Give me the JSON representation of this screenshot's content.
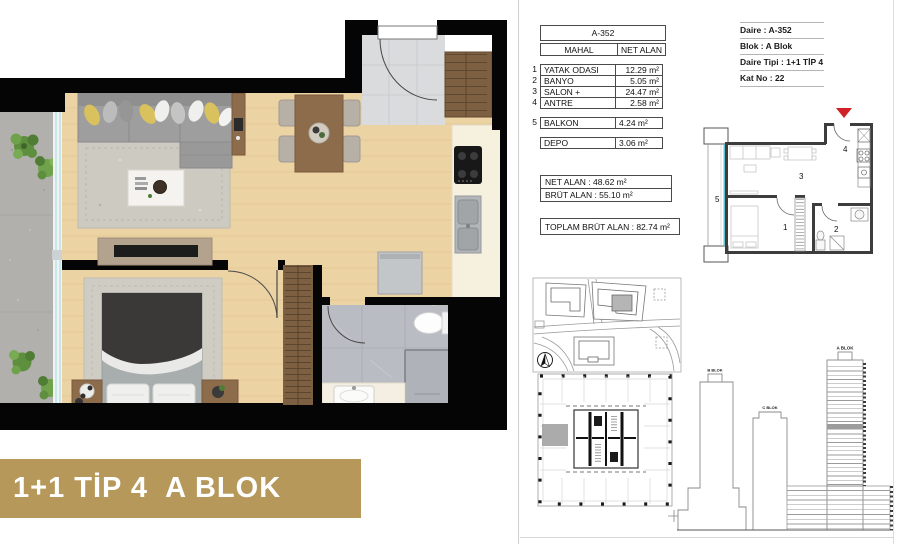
{
  "footer": {
    "label": "1+1 TİP 4  A BLOK"
  },
  "unit_table": {
    "unit_no": "A-352",
    "columns": {
      "mahal": "MAHAL",
      "net_alan": "NET ALAN"
    },
    "rows": [
      {
        "no": "1",
        "name": "YATAK ODASI",
        "area": "12.29 m²"
      },
      {
        "no": "2",
        "name": "BANYO",
        "area": "5.05 m²"
      },
      {
        "no": "3",
        "name": "SALON + MUTFAK",
        "area": "24.47 m²"
      },
      {
        "no": "4",
        "name": "ANTRE",
        "area": "2.58 m²"
      }
    ],
    "balkon_row": {
      "no": "5",
      "name": "BALKON",
      "area": "4.24 m²"
    },
    "depo_row": {
      "no": "",
      "name": "DEPO",
      "area": "3.06 m²"
    },
    "summary": {
      "net": "NET ALAN : 48.62 m²",
      "brut": "BRÜT ALAN : 55.10 m²",
      "toplam": "TOPLAM BRÜT ALAN : 82.74 m²"
    }
  },
  "unit_info": {
    "daire": "Daire : A-352",
    "blok": "Blok : A Blok",
    "tipi": "Daire Tipi : 1+1 TİP 4",
    "kat": "Kat No : 22"
  },
  "schematic_plan": {
    "rooms": {
      "yatak_odasi": "1",
      "banyo": "2",
      "salon_mutfak": "3",
      "antre": "4",
      "balkon": "5"
    }
  },
  "elevation": {
    "a_blok": "A BLOK",
    "b_blok": "B BLOK",
    "c_blok": "C BLOK"
  },
  "colors": {
    "accent_gold": "#b5985a",
    "marker_red": "#cf2127",
    "highlight_gray": "#9c9c9c",
    "glass_cyan": "#62c4d2",
    "wood_floor": "#ecd3a3"
  }
}
